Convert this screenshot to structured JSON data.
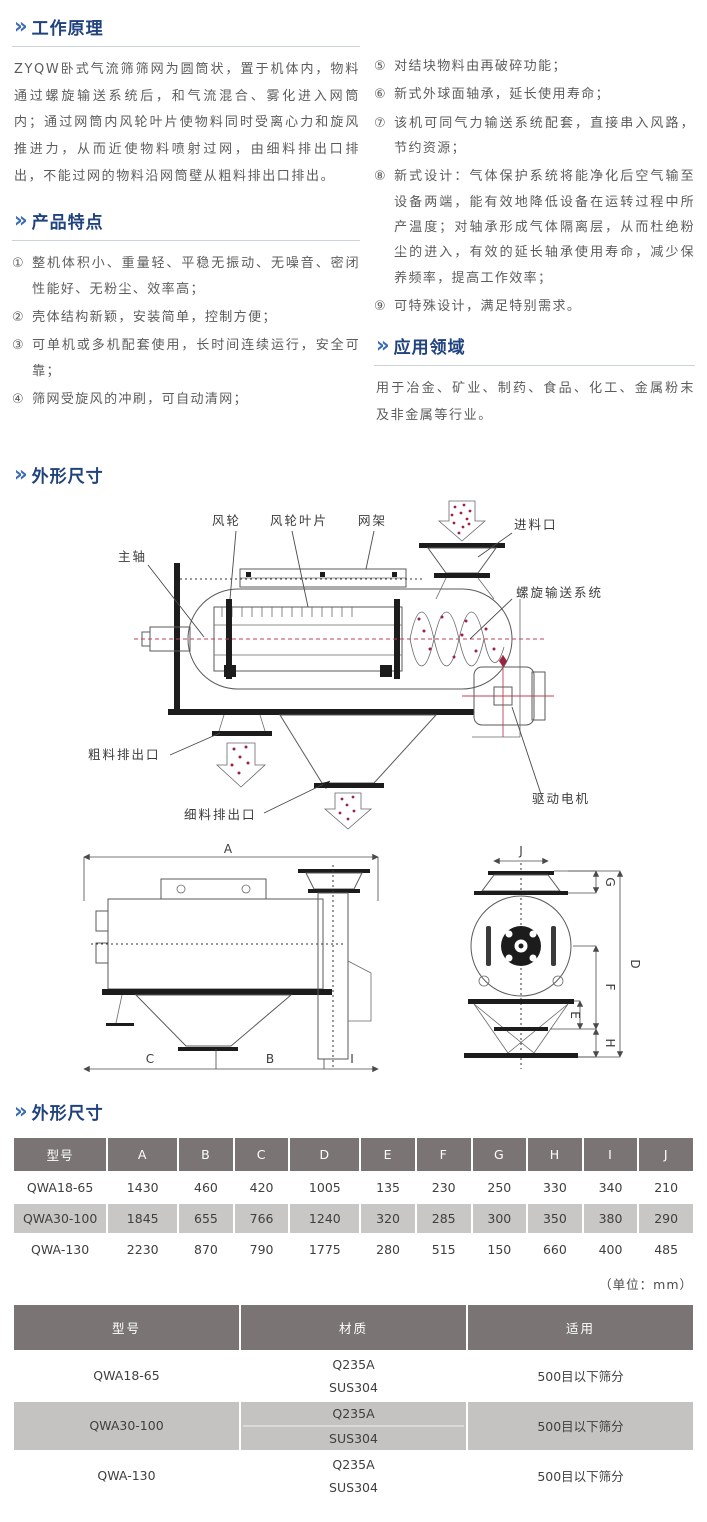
{
  "ui": {
    "chevron": "»"
  },
  "colors": {
    "title_blue": "#20427e",
    "chevron_blue": "#3a6cb4",
    "table_header_bg": "#7a7574",
    "alt_row_bg": "#c9c7c5",
    "particle_red": "#9e2240"
  },
  "working_principle": {
    "title": "工作原理",
    "body": "ZYQW卧式气流筛筛网为圆筒状，置于机体内，物料通过螺旋输送系统后，和气流混合、雾化进入网筒内；通过网筒内风轮叶片使物料同时受离心力和旋风推进力，从而近使物料喷射过网，由细料排出口排出，不能过网的物料沿网筒壁从粗料排出口排出。"
  },
  "features": {
    "title": "产品特点",
    "left": [
      {
        "num": "①",
        "text": "整机体积小、重量轻、平稳无振动、无噪音、密闭性能好、无粉尘、效率高；"
      },
      {
        "num": "②",
        "text": "壳体结构新颖，安装简单，控制方便；"
      },
      {
        "num": "③",
        "text": "可单机或多机配套使用，长时间连续运行，安全可靠；"
      },
      {
        "num": "④",
        "text": "筛网受旋风的冲刷，可自动清网；"
      }
    ],
    "right": [
      {
        "num": "⑤",
        "text": "对结块物料由再破碎功能；"
      },
      {
        "num": "⑥",
        "text": "新式外球面轴承，延长使用寿命；"
      },
      {
        "num": "⑦",
        "text": "该机可同气力输送系统配套，直接串入风路，节约资源；"
      },
      {
        "num": "⑧",
        "text": "新式设计：气体保护系统将能净化后空气输至设备两端，能有效地降低设备在运转过程中所产温度；对轴承形成气体隔离层，从而杜绝粉尘的进入，有效的延长轴承使用寿命，减少保养频率，提高工作效率；"
      },
      {
        "num": "⑨",
        "text": "可特殊设计，满足特别需求。"
      }
    ]
  },
  "application": {
    "title": "应用领域",
    "body": "用于冶金、矿业、制药、食品、化工、金属粉末及非金属等行业。"
  },
  "outline": {
    "title": "外形尺寸",
    "unit": "（单位：mm）"
  },
  "diagram": {
    "labels": {
      "main_shaft": "主轴",
      "wind_wheel": "风轮",
      "wind_blade": "风轮叶片",
      "net_frame": "网架",
      "feed_inlet": "进料口",
      "screw_system": "螺旋输送系统",
      "coarse_outlet": "粗料排出口",
      "fine_outlet": "细料排出口",
      "drive_motor": "驱动电机"
    },
    "dims": {
      "A": "A",
      "B": "B",
      "C": "C",
      "D": "D",
      "E": "E",
      "F": "F",
      "G": "G",
      "H": "H",
      "I": "I",
      "J": "J"
    }
  },
  "dim_table": {
    "headers": [
      "型号",
      "A",
      "B",
      "C",
      "D",
      "E",
      "F",
      "G",
      "H",
      "I",
      "J"
    ],
    "rows": [
      [
        "QWA18-65",
        "1430",
        "460",
        "420",
        "1005",
        "135",
        "230",
        "250",
        "330",
        "340",
        "210"
      ],
      [
        "QWA30-100",
        "1845",
        "655",
        "766",
        "1240",
        "320",
        "285",
        "300",
        "350",
        "380",
        "290"
      ],
      [
        "QWA-130",
        "2230",
        "870",
        "790",
        "1775",
        "280",
        "515",
        "150",
        "660",
        "400",
        "485"
      ]
    ]
  },
  "material_table": {
    "headers": [
      "型号",
      "材质",
      "适用"
    ],
    "rows": [
      {
        "model": "QWA18-65",
        "materials": [
          "Q235A",
          "SUS304"
        ],
        "application": "500目以下筛分"
      },
      {
        "model": "QWA30-100",
        "materials": [
          "Q235A",
          "SUS304"
        ],
        "application": "500目以下筛分"
      },
      {
        "model": "QWA-130",
        "materials": [
          "Q235A",
          "SUS304"
        ],
        "application": "500目以下筛分"
      }
    ]
  }
}
